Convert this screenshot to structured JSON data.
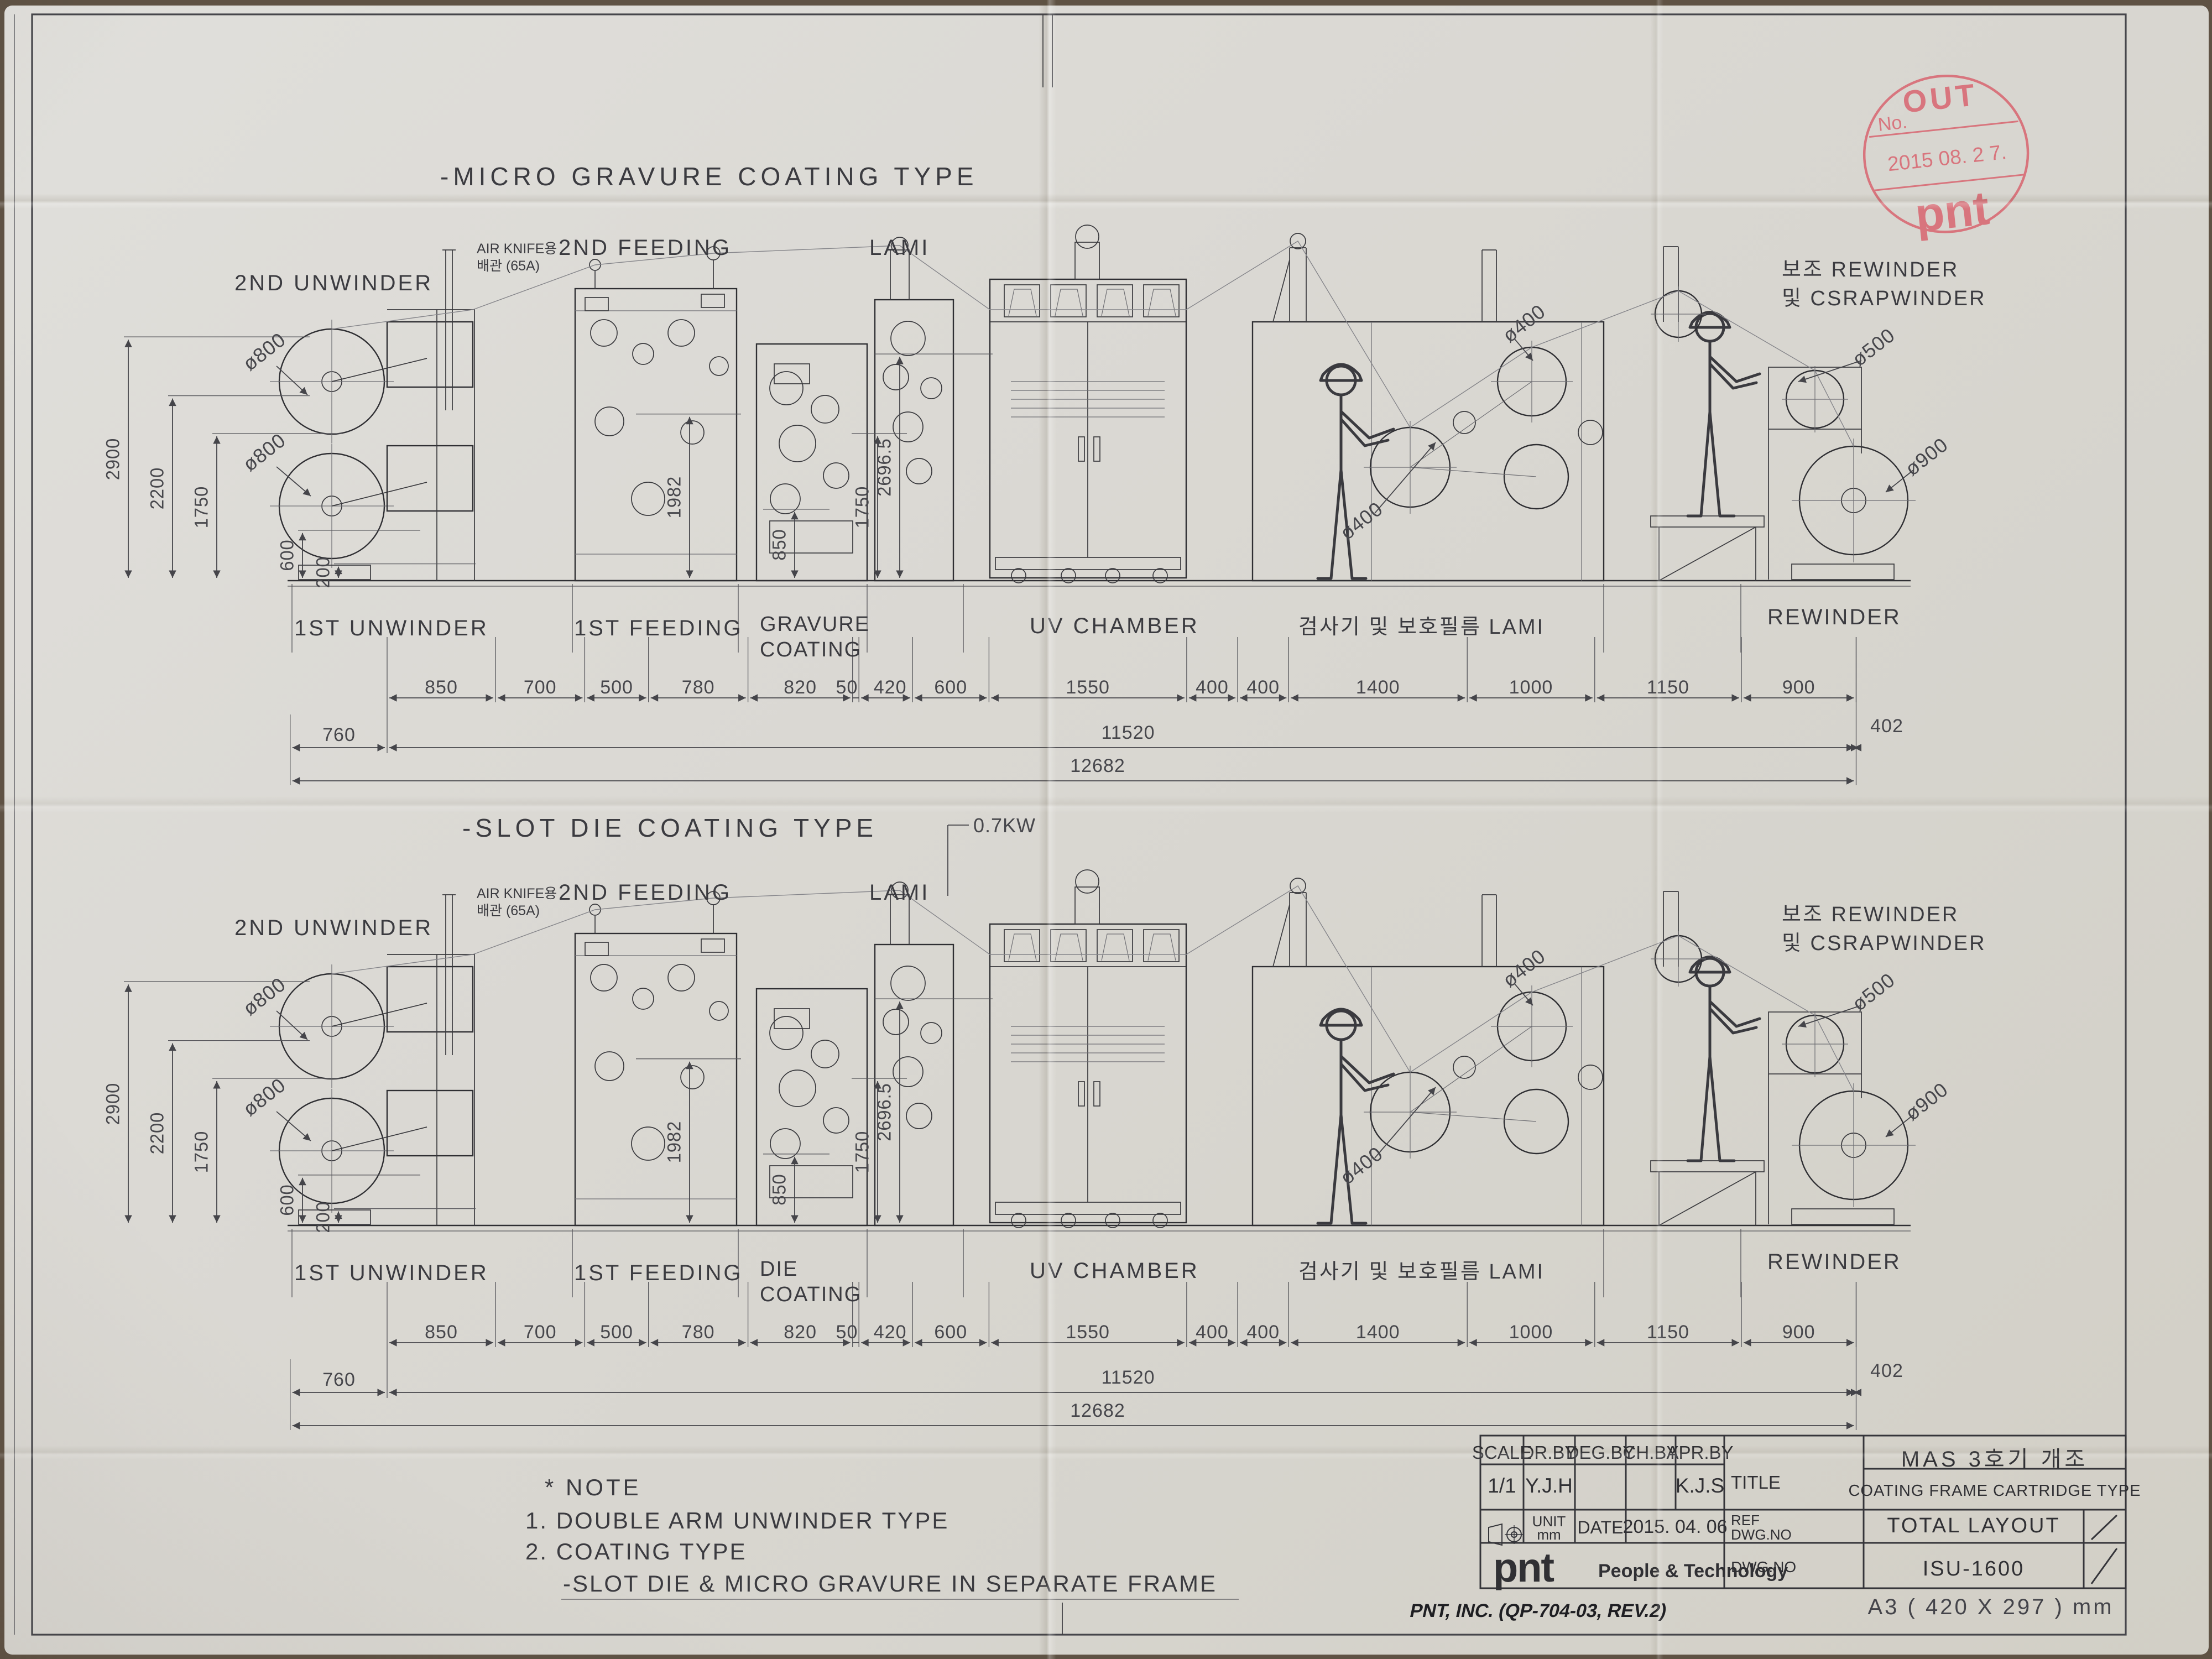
{
  "sheet": {
    "footer_left": "PNT, INC. (QP-704-03, REV.2)",
    "footer_right": "A3 ( 420 X 297 ) mm"
  },
  "stamp": {
    "word": "OUT",
    "no_label": "No.",
    "date": "2015  08. 2 7.",
    "logo": "pnt",
    "color": "#d8606c"
  },
  "note": {
    "header": "* NOTE",
    "line1": "1. DOUBLE ARM UNWINDER TYPE",
    "line2": "2. COATING TYPE",
    "line3": "-SLOT DIE & MICRO GRAVURE IN SEPARATE FRAME"
  },
  "title_block": {
    "headers": [
      "SCALE",
      "DR.BY",
      "DEG.BY",
      "CH.BY",
      "APR.BY"
    ],
    "scale_value": "1/1",
    "dr_by_value": "Y.J.H",
    "deg_by_value": "",
    "ch_by_value": "",
    "apr_by_value": "K.J.S",
    "title_label": "TITLE",
    "unit_label": "UNIT",
    "unit_value": "mm",
    "date_label": "DATE",
    "date_value": "2015. 04. 06",
    "ref_label_1": "REF",
    "ref_label_2": "DWG.NO",
    "dwg_label": "DWG.NO",
    "project_title": "MAS 3호기 개조",
    "project_subtitle": "COATING FRAME CARTRIDGE TYPE",
    "ref_value": "TOTAL LAYOUT",
    "dwg_value": "ISU-1600",
    "logo": "pnt",
    "logo_caption": "People & Technology"
  },
  "drawings": [
    {
      "title": "-MICRO GRAVURE COATING TYPE",
      "second_unwinder": "2ND UNWINDER",
      "air_knife_1": "AIR KNIFE용",
      "air_knife_2": "배관 (65A)",
      "second_feeding": "2ND FEEDING",
      "lami": "LAMI",
      "aux_rewinder_1": "보조 REWINDER",
      "aux_rewinder_2": "및 CSRAPWINDER",
      "first_unwinder": "1ST UNWINDER",
      "first_feeding": "1ST FEEDING",
      "coating_1": "GRAVURE",
      "coating_2": "COATING",
      "uv_chamber": "UV CHAMBER",
      "inspection": "검사기 및 보호필름 LAMI",
      "rewinder": "REWINDER",
      "left_dims": [
        "2900",
        "2200",
        "1750",
        "600",
        "200"
      ],
      "mid_dims": [
        "1982",
        "850",
        "1750",
        "2696.5"
      ],
      "roll_dias": [
        "ø800",
        "ø800",
        "ø400",
        "ø400",
        "ø500",
        "ø900"
      ],
      "dim_chain": [
        "850",
        "700",
        "500",
        "780",
        "820",
        "50",
        "420",
        "600",
        "1550",
        "400",
        "400",
        "1400",
        "1000",
        "1150",
        "900"
      ],
      "dim_right": "402",
      "dim_left": "760",
      "dim_total_1": "11520",
      "dim_total_2": "12682"
    },
    {
      "title": "-SLOT DIE COATING TYPE",
      "power": "0.7KW",
      "second_unwinder": "2ND UNWINDER",
      "air_knife_1": "AIR KNIFE용",
      "air_knife_2": "배관 (65A)",
      "second_feeding": "2ND FEEDING",
      "lami": "LAMI",
      "aux_rewinder_1": "보조 REWINDER",
      "aux_rewinder_2": "및 CSRAPWINDER",
      "first_unwinder": "1ST UNWINDER",
      "first_feeding": "1ST FEEDING",
      "coating_1": "DIE",
      "coating_2": "COATING",
      "uv_chamber": "UV CHAMBER",
      "inspection": "검사기 및 보호필름 LAMI",
      "rewinder": "REWINDER",
      "left_dims": [
        "2900",
        "2200",
        "1750",
        "600",
        "200"
      ],
      "mid_dims": [
        "1982",
        "850",
        "1750",
        "2696.5"
      ],
      "roll_dias": [
        "ø800",
        "ø800",
        "ø400",
        "ø400",
        "ø500",
        "ø900"
      ],
      "dim_chain": [
        "850",
        "700",
        "500",
        "780",
        "820",
        "50",
        "420",
        "600",
        "1550",
        "400",
        "400",
        "1400",
        "1000",
        "1150",
        "900"
      ],
      "dim_right": "402",
      "dim_left": "760",
      "dim_total_1": "11520",
      "dim_total_2": "12682"
    }
  ]
}
